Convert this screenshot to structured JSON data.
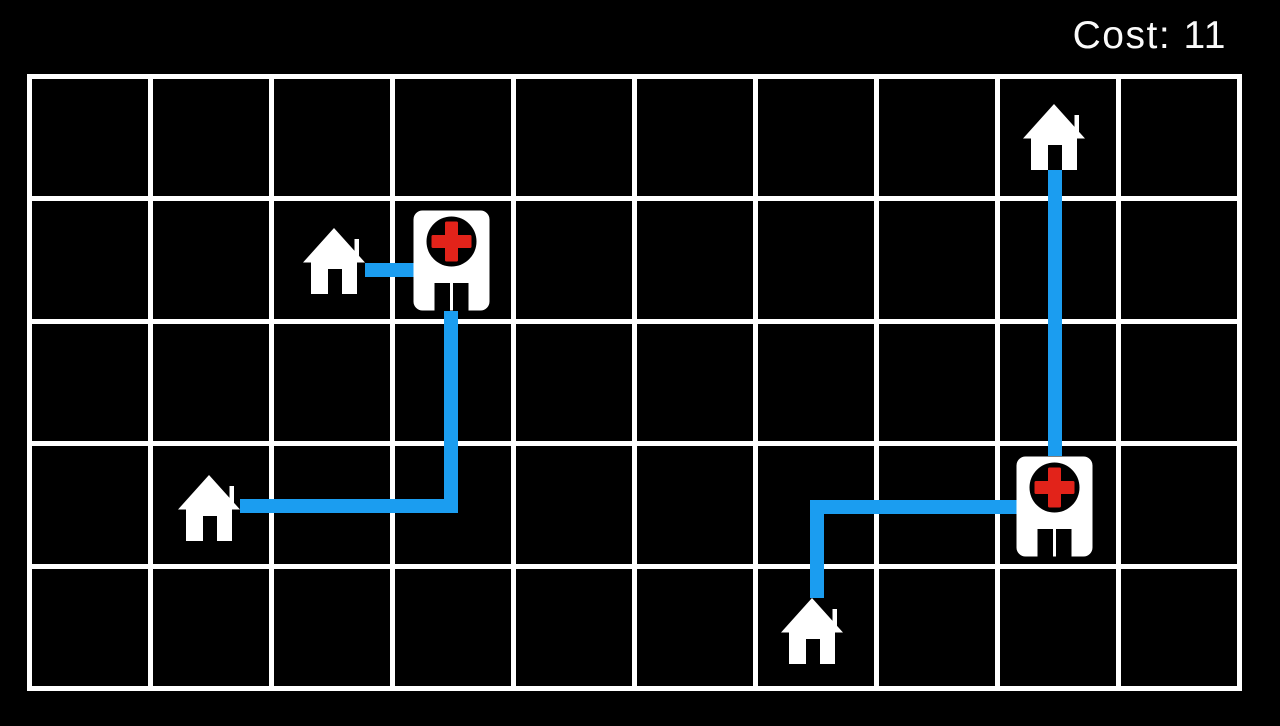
{
  "hud": {
    "cost_label": "Cost: 11"
  },
  "colors": {
    "background": "#000000",
    "grid_line": "#ffffff",
    "path_blue": "#1b9df0",
    "cross_red": "#e2231a",
    "building_white": "#ffffff",
    "text_white": "#fafafa"
  },
  "board": {
    "columns": 10,
    "rows": 5,
    "cost_value": 11,
    "houses": [
      {
        "id": "house-1",
        "col": 2,
        "row": 1,
        "x": 303,
        "y": 228
      },
      {
        "id": "house-2",
        "col": 1,
        "row": 3,
        "x": 178,
        "y": 475
      },
      {
        "id": "house-3",
        "col": 6,
        "row": 4,
        "x": 781,
        "y": 598
      },
      {
        "id": "house-4",
        "col": 8,
        "row": 0,
        "x": 1023,
        "y": 104
      }
    ],
    "hospitals": [
      {
        "id": "hospital-1",
        "col": 3,
        "row": 1,
        "x": 413,
        "y": 210
      },
      {
        "id": "hospital-2",
        "col": 8,
        "row": 3,
        "x": 1016,
        "y": 456
      }
    ],
    "path_segments": [
      {
        "id": "path-house1-to-hospital1",
        "x": 356,
        "y": 263,
        "w": 58,
        "h": 14
      },
      {
        "id": "path-house2-horizontal",
        "x": 236,
        "y": 499,
        "w": 222,
        "h": 14
      },
      {
        "id": "path-house2-vertical",
        "x": 444,
        "y": 311,
        "w": 14,
        "h": 202
      },
      {
        "id": "path-house3-vertical",
        "x": 810,
        "y": 500,
        "w": 14,
        "h": 104
      },
      {
        "id": "path-house3-horizontal",
        "x": 810,
        "y": 500,
        "w": 207,
        "h": 14
      },
      {
        "id": "path-house4-vertical",
        "x": 1048,
        "y": 170,
        "w": 14,
        "h": 286
      }
    ]
  }
}
